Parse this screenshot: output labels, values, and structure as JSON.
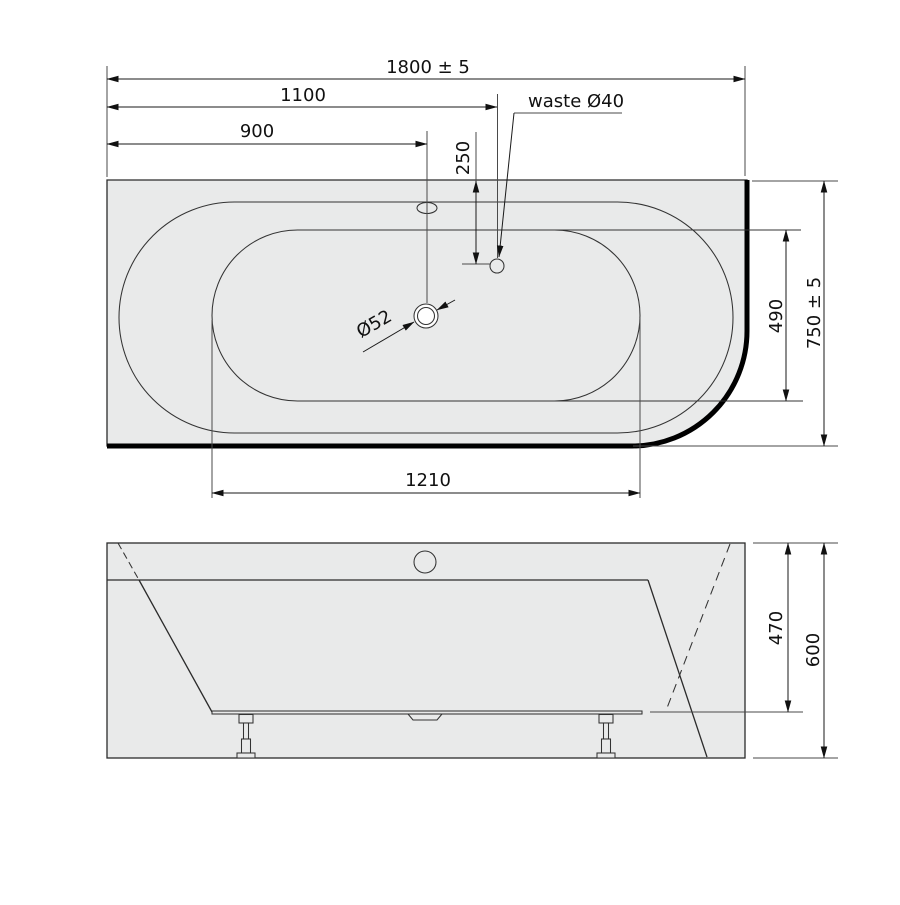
{
  "drawing": {
    "type": "technical-drawing",
    "subject": "corner bathtub plan and front elevation with dimensions",
    "colors": {
      "body_fill": "#e9eaea",
      "outline": "#2b2b2b",
      "wall_edge": "#000000",
      "dimension_line": "#1a1a1a",
      "background": "#ffffff"
    },
    "top_view": {
      "dimensions": {
        "overall_length": "1800 ± 5",
        "length_to_waste": "1100",
        "length_to_drain": "900",
        "waste_offset_from_back": "250",
        "waste_label": "waste Ø40",
        "drain_diameter": "Ø52",
        "basin_width": "490",
        "overall_width": "750 ± 5",
        "basin_length": "1210"
      }
    },
    "side_view": {
      "dimensions": {
        "rim_to_skirt_height": "470",
        "total_height": "600"
      }
    }
  }
}
